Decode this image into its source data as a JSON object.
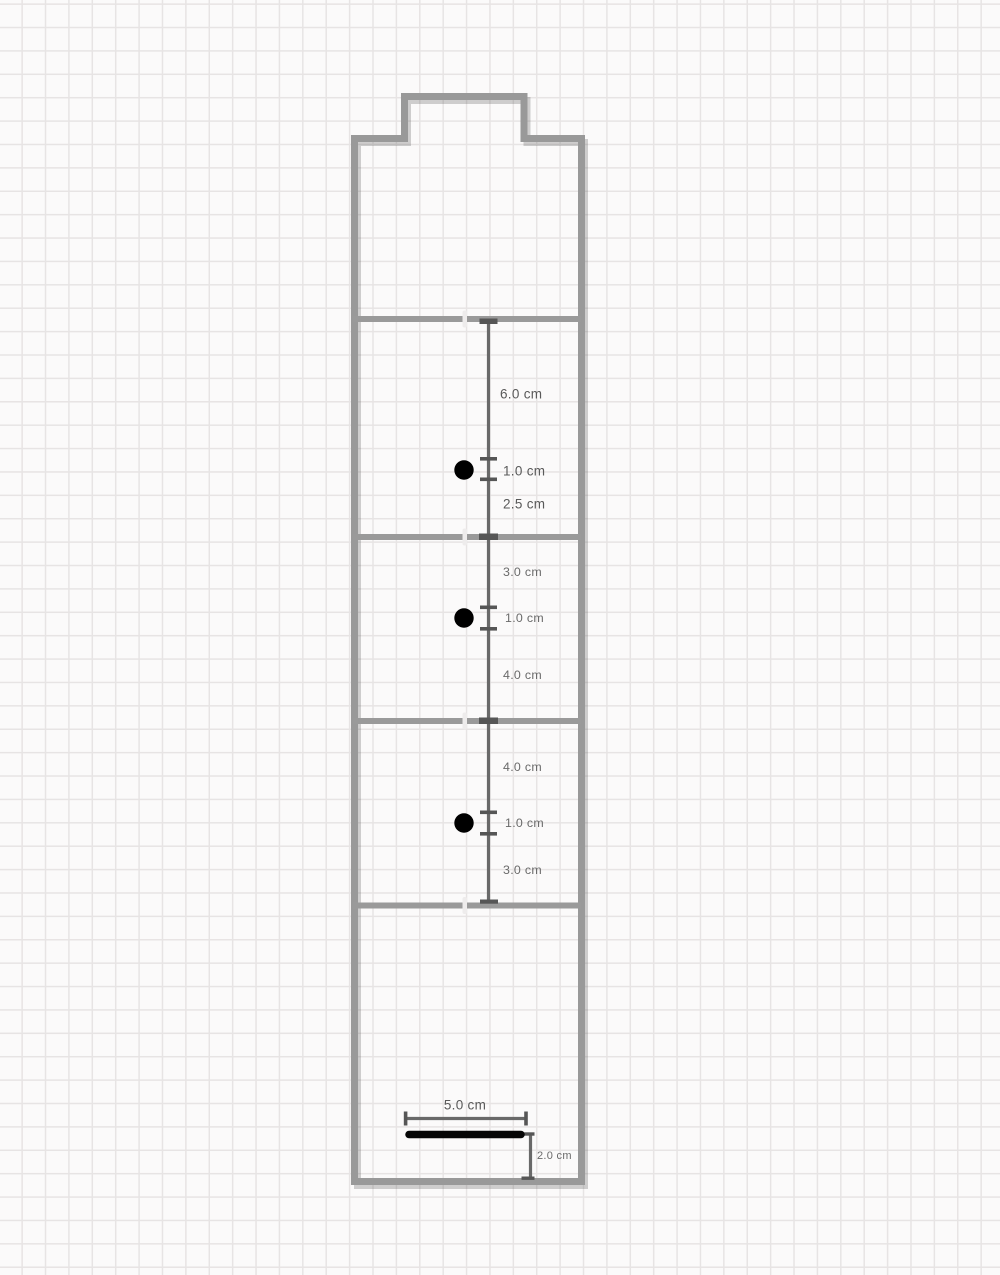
{
  "canvas": {
    "type": "graph-paper-drawing",
    "background_color": "#fbfafa",
    "grid_color": "#e7e4e4",
    "grid_cell_px": 23.4
  },
  "template": {
    "outline_color": "#999999",
    "fold_line_color": "#9a9a9a",
    "hole_color": "#000000",
    "slot_color": "#060606",
    "dimension_color": "#696969",
    "label_color": "#595959"
  },
  "dimensions": {
    "sections": [
      {
        "above_hole": "6.0 cm",
        "hole_diameter": "1.0 cm",
        "below_hole": "2.5 cm"
      },
      {
        "above_hole": "3.0 cm",
        "hole_diameter": "1.0 cm",
        "below_hole": "4.0 cm"
      },
      {
        "above_hole": "4.0 cm",
        "hole_diameter": "1.0 cm",
        "below_hole": "3.0 cm"
      }
    ],
    "slot": {
      "width": "5.0 cm",
      "distance_from_bottom": "2.0 cm"
    }
  }
}
